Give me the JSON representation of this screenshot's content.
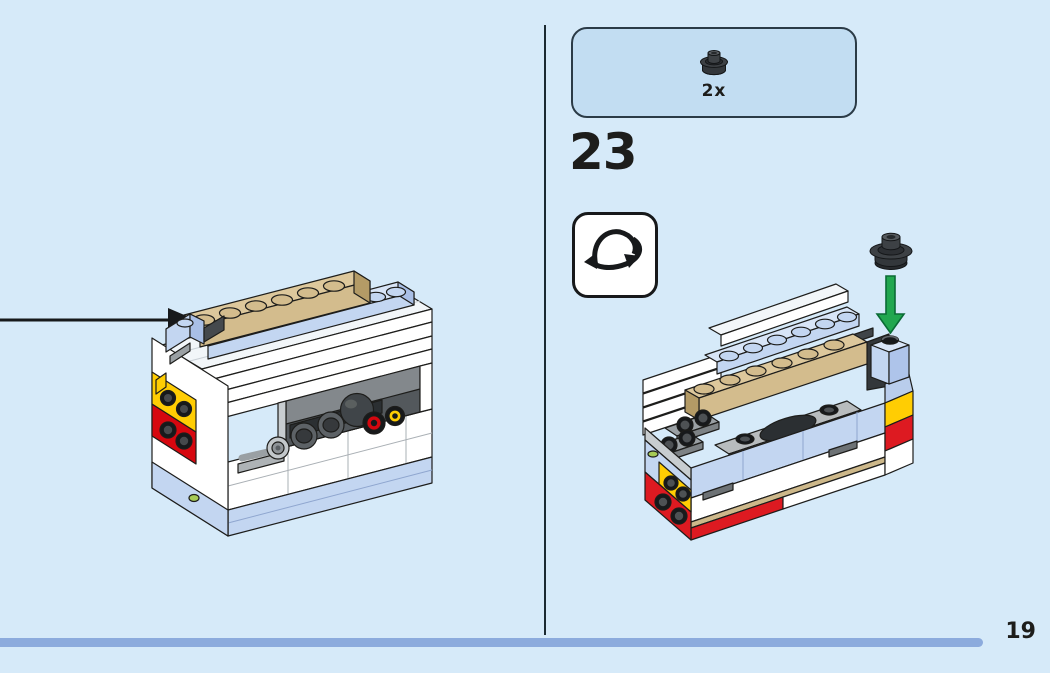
{
  "page": {
    "background_color": "#d6eaf9",
    "number": "19"
  },
  "divider": {
    "color": "#1b2a32"
  },
  "footer": {
    "bar_color": "#8cabdd"
  },
  "step": {
    "number": "23"
  },
  "parts_callout": {
    "fill_color": "#c2ddf2",
    "border_color": "#2b3b47",
    "parts": [
      {
        "icon": "round-plate-dark-gray-part-icon",
        "quantity": "2x"
      }
    ]
  },
  "icons": {
    "rotate_3d": "rotate-3d-icon"
  },
  "illustrations": {
    "left_model": "lego-model-front-left-view",
    "right_model": "lego-model-rear-view",
    "attach_arrow": "black-attach-arrow",
    "placement_arrow": "green-placement-arrow",
    "placement_part": "dark-gray-round-plate-part"
  },
  "palette": {
    "white_brick": "#ffffff",
    "light_blue_brick": "#c3d6f1",
    "tan_brick": "#d3bc8d",
    "dark_gray": "#3f4448",
    "light_gray": "#b8bcbe",
    "red": "#dd1a21",
    "yellow": "#ffcd03",
    "lime": "#a6ca55",
    "green_arrow": "#21a74f",
    "outline": "#1d1d1b"
  }
}
